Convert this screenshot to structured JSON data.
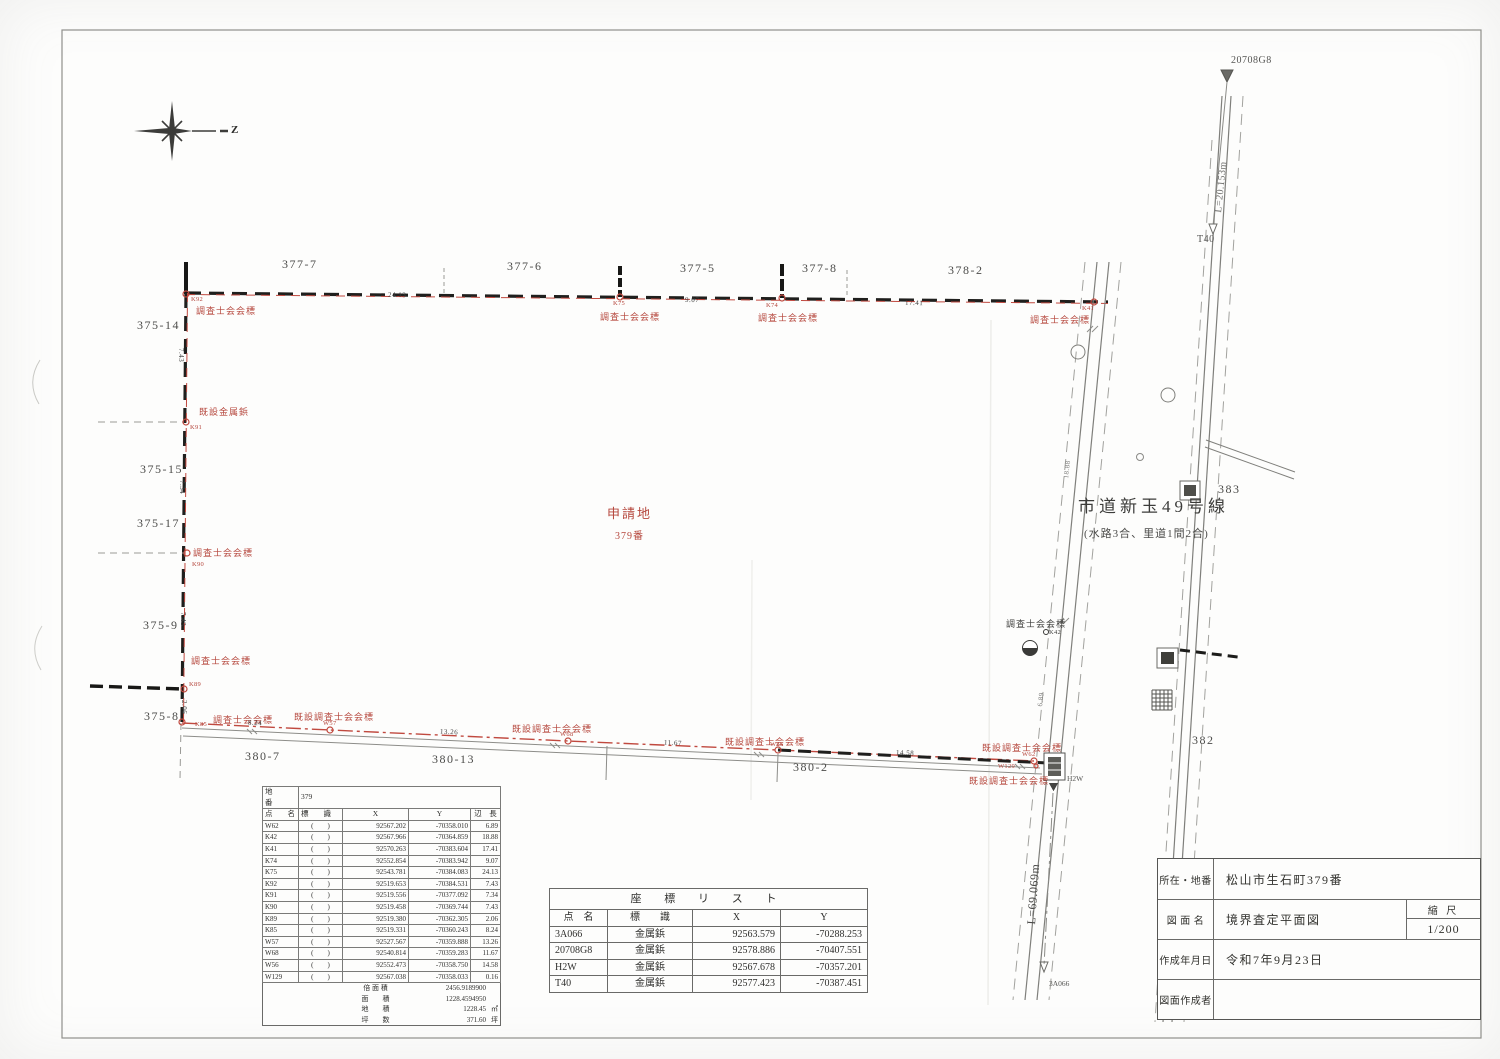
{
  "map": {
    "north": "Z",
    "site_label": "申請地",
    "site_number": "379番",
    "road_name": "市道新玉49号線",
    "road_note": "(水路3合、里道1間2合)",
    "len_20708g8_t40": "L=20.153m",
    "len_h2w_3a066": "L=69.069m",
    "pt_20708g8": "20708G8",
    "pt_t40": "T40",
    "pt_3a066": "3A066",
    "pt_h2w": "H2W",
    "parcels": [
      "377-7",
      "377-6",
      "377-5",
      "377-8",
      "378-2",
      "375-14",
      "375-15",
      "375-17",
      "375-9",
      "375-8",
      "380-7",
      "380-13",
      "380-2",
      "383",
      "382"
    ],
    "marks": [
      {
        "id": "K92",
        "type": "調査士会会標"
      },
      {
        "id": "K75",
        "type": "調査士会会標"
      },
      {
        "id": "K74",
        "type": "調査士会会標"
      },
      {
        "id": "K41",
        "type": "調査士会会標"
      },
      {
        "id": "K91",
        "type": "既設金属鋲"
      },
      {
        "id": "K90",
        "type": "調査士会会標"
      },
      {
        "id": "K89",
        "type": "調査士会会標"
      },
      {
        "id": "K85",
        "type": "調査士会会標"
      },
      {
        "id": "W57",
        "type": "既設調査士会会標"
      },
      {
        "id": "W68",
        "type": "既設調査士会会標"
      },
      {
        "id": "W56",
        "type": "既設調査士会会標"
      },
      {
        "id": "W62",
        "type": "既設調査士会会標"
      },
      {
        "id": "W129",
        "type": "既設調査士会会標"
      },
      {
        "id": "K42",
        "type": "調査士会会標"
      }
    ],
    "dims": [
      "24.13",
      "9.07",
      "17.41",
      "7.43",
      "7.34",
      "7.43",
      "2.06",
      "8.24",
      "13.26",
      "11.67",
      "14.58",
      "18.88",
      "6.89"
    ]
  },
  "point_table": {
    "lot_label": "地　　番",
    "lot_value": "379",
    "headers": {
      "name": "点　　名",
      "mark": "標　　識",
      "x": "X",
      "y": "Y",
      "len": "辺　長"
    },
    "paren": "(        )",
    "rows": [
      {
        "name": "W62",
        "x": "92567.202",
        "y": "-70358.010",
        "len": "6.89"
      },
      {
        "name": "K42",
        "x": "92567.966",
        "y": "-70364.859",
        "len": "18.88"
      },
      {
        "name": "K41",
        "x": "92570.263",
        "y": "-70383.604",
        "len": "17.41"
      },
      {
        "name": "K74",
        "x": "92552.854",
        "y": "-70383.942",
        "len": "9.07"
      },
      {
        "name": "K75",
        "x": "92543.781",
        "y": "-70384.083",
        "len": "24.13"
      },
      {
        "name": "K92",
        "x": "92519.653",
        "y": "-70384.531",
        "len": "7.43"
      },
      {
        "name": "K91",
        "x": "92519.556",
        "y": "-70377.092",
        "len": "7.34"
      },
      {
        "name": "K90",
        "x": "92519.458",
        "y": "-70369.744",
        "len": "7.43"
      },
      {
        "name": "K89",
        "x": "92519.380",
        "y": "-70362.305",
        "len": "2.06"
      },
      {
        "name": "K85",
        "x": "92519.331",
        "y": "-70360.243",
        "len": "8.24"
      },
      {
        "name": "W57",
        "x": "92527.567",
        "y": "-70359.888",
        "len": "13.26"
      },
      {
        "name": "W68",
        "x": "92540.814",
        "y": "-70359.283",
        "len": "11.67"
      },
      {
        "name": "W56",
        "x": "92552.473",
        "y": "-70358.750",
        "len": "14.58"
      },
      {
        "name": "W129",
        "x": "92567.038",
        "y": "-70358.033",
        "len": "0.16"
      }
    ],
    "footer": [
      {
        "label": "倍 面 積",
        "value": "2456.9189900",
        "unit": ""
      },
      {
        "label": "面　　積",
        "value": "1228.4594950",
        "unit": ""
      },
      {
        "label": "地　　積",
        "value": "1228.45",
        "unit": "㎡"
      },
      {
        "label": "坪　　数",
        "value": "371.60",
        "unit": "坪"
      }
    ]
  },
  "coord_table": {
    "title": "座 標 リ ス ト",
    "headers": {
      "name": "点　名",
      "mark": "標　　識",
      "x": "X",
      "y": "Y"
    },
    "rows": [
      {
        "name": "3A066",
        "mark": "金属鋲",
        "x": "92563.579",
        "y": "-70288.253"
      },
      {
        "name": "20708G8",
        "mark": "金属鋲",
        "x": "92578.886",
        "y": "-70407.551"
      },
      {
        "name": "H2W",
        "mark": "金属鋲",
        "x": "92567.678",
        "y": "-70357.201"
      },
      {
        "name": "T40",
        "mark": "金属鋲",
        "x": "92577.423",
        "y": "-70387.451"
      }
    ]
  },
  "title_block": {
    "rows": [
      {
        "label": "所在・地番",
        "value": "松山市生石町379番"
      },
      {
        "label": "図 面 名",
        "value": "境界査定平面図"
      },
      {
        "label": "作成年月日",
        "value": "令和7年9月23日"
      },
      {
        "label": "図面作成者",
        "value": ""
      }
    ],
    "scale_label": "縮 尺",
    "scale_value": "1/200"
  }
}
